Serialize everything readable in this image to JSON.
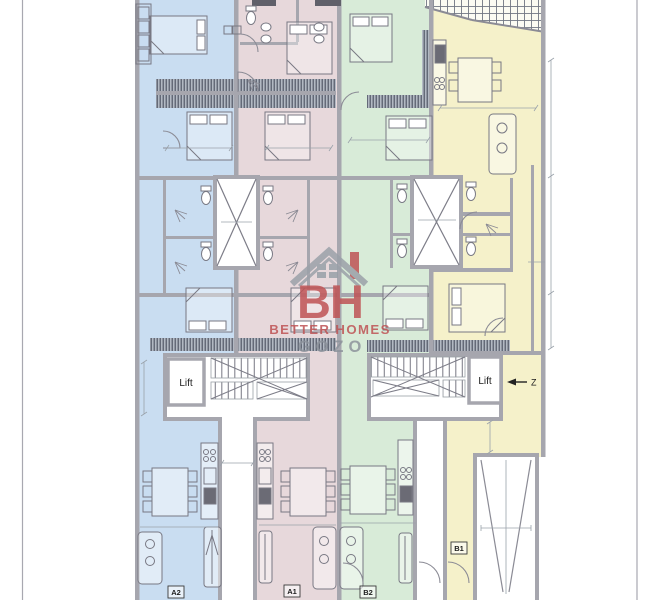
{
  "plan": {
    "watermark": {
      "monogram": "BH",
      "line1": "BETTER HOMES",
      "line2": "GOZO"
    },
    "labels": {
      "lift_left": "Lift",
      "lift_right": "Lift",
      "section_marker": "Z",
      "apartment_a2": "A2",
      "apartment_a1": "A1",
      "apartment_b2": "B2",
      "apartment_b1": "B1"
    },
    "colors": {
      "zone_blue": "#c9ddf1",
      "zone_pink": "#e7d8db",
      "zone_green": "#d8ebd8",
      "zone_yellow": "#f5f1ca",
      "walls": "#a6a6ae",
      "logo_red": "#bf5355",
      "logo_gray": "#8d939c",
      "white": "#ffffff"
    }
  }
}
